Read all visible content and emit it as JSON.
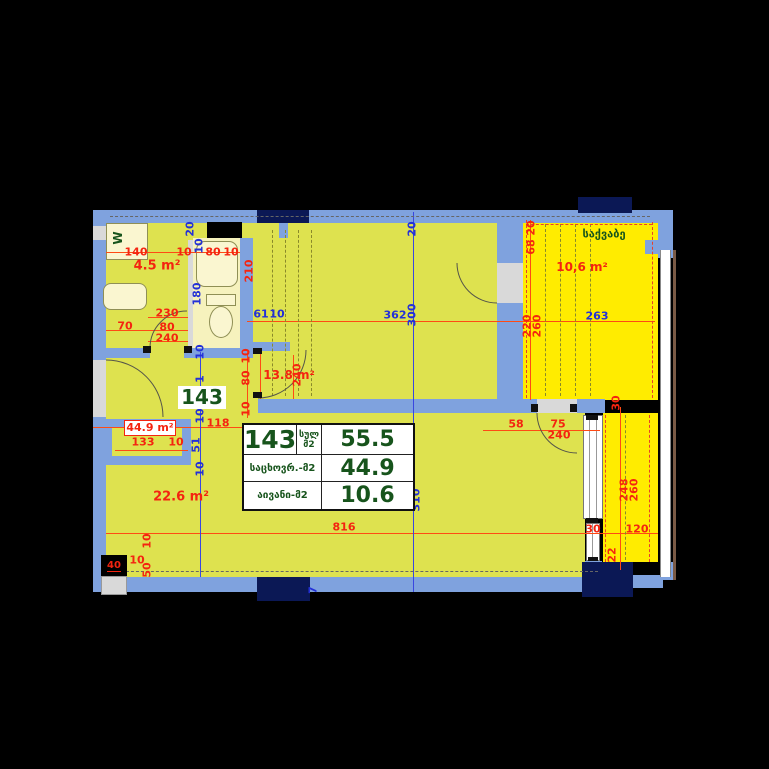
{
  "plan": {
    "apartment_number": "143",
    "rooms": {
      "bathroom": {
        "area": "4.5 m²"
      },
      "bedroom": {
        "area": "13.8 m²"
      },
      "living": {
        "area": "22.6 m²"
      },
      "hall": {
        "area": "44.9 m²"
      },
      "boiler": {
        "name": "საქვაბე",
        "area": "10,6 m²"
      }
    },
    "washer_label": "W",
    "shaft_label": "40"
  },
  "summary_table": {
    "unit": "143",
    "total_unit_label": [
      "სულ",
      "მ2"
    ],
    "total_value": "55.5",
    "rows": [
      {
        "label": "საცხოვრ.-მ2",
        "value": "44.9"
      },
      {
        "label": "აივანი-მ2",
        "value": "10.6"
      }
    ]
  },
  "colors": {
    "wall": "#7FA2DE",
    "column": "#0B1855",
    "interior": "#DEE24F",
    "balcony": "#FFEC00",
    "pale_room": "#F6F2BD",
    "dim_red": "#F42410",
    "dim_blue": "#2330D8",
    "label_green": "#17541C",
    "background": "#000000"
  },
  "dims": [
    {
      "t": "140",
      "x": 136,
      "y": 252,
      "o": "h",
      "c": "r"
    },
    {
      "t": "10",
      "x": 184,
      "y": 252,
      "o": "h",
      "c": "r"
    },
    {
      "t": "80",
      "x": 213,
      "y": 252,
      "o": "h",
      "c": "r"
    },
    {
      "t": "10",
      "x": 231,
      "y": 252,
      "o": "h",
      "c": "r"
    },
    {
      "t": "230",
      "x": 167,
      "y": 313,
      "o": "h",
      "c": "r"
    },
    {
      "t": "70",
      "x": 125,
      "y": 326,
      "o": "h",
      "c": "r"
    },
    {
      "t": "80",
      "x": 167,
      "y": 327,
      "o": "h",
      "c": "r"
    },
    {
      "t": "240",
      "x": 167,
      "y": 338,
      "o": "h",
      "c": "r"
    },
    {
      "t": "118",
      "x": 218,
      "y": 423,
      "o": "h",
      "c": "r"
    },
    {
      "t": "133",
      "x": 143,
      "y": 442,
      "o": "h",
      "c": "r"
    },
    {
      "t": "10",
      "x": 176,
      "y": 442,
      "o": "h",
      "c": "r"
    },
    {
      "t": "58",
      "x": 516,
      "y": 424,
      "o": "h",
      "c": "r"
    },
    {
      "t": "75",
      "x": 558,
      "y": 424,
      "o": "h",
      "c": "r"
    },
    {
      "t": "240",
      "x": 559,
      "y": 435,
      "o": "h",
      "c": "r"
    },
    {
      "t": "816",
      "x": 344,
      "y": 527,
      "o": "h",
      "c": "r"
    },
    {
      "t": "30",
      "x": 593,
      "y": 529,
      "o": "h",
      "c": "r"
    },
    {
      "t": "120",
      "x": 637,
      "y": 529,
      "o": "h",
      "c": "r"
    },
    {
      "t": "10",
      "x": 137,
      "y": 560,
      "o": "h",
      "c": "r"
    },
    {
      "t": "210",
      "x": 249,
      "y": 271,
      "o": "v",
      "c": "r"
    },
    {
      "t": "10",
      "x": 246,
      "y": 356,
      "o": "v",
      "c": "r"
    },
    {
      "t": "80",
      "x": 246,
      "y": 378,
      "o": "v",
      "c": "r"
    },
    {
      "t": "10",
      "x": 246,
      "y": 409,
      "o": "v",
      "c": "r"
    },
    {
      "t": "240",
      "x": 297,
      "y": 375,
      "o": "v",
      "c": "r"
    },
    {
      "t": "20",
      "x": 531,
      "y": 228,
      "o": "v",
      "c": "r"
    },
    {
      "t": "68",
      "x": 531,
      "y": 247,
      "o": "v",
      "c": "r"
    },
    {
      "t": "220",
      "x": 527,
      "y": 326,
      "o": "v",
      "c": "r"
    },
    {
      "t": "260",
      "x": 537,
      "y": 326,
      "o": "v",
      "c": "r"
    },
    {
      "t": "30",
      "x": 616,
      "y": 403,
      "o": "v",
      "c": "r"
    },
    {
      "t": "248",
      "x": 624,
      "y": 490,
      "o": "v",
      "c": "r"
    },
    {
      "t": "260",
      "x": 634,
      "y": 490,
      "o": "v",
      "c": "r"
    },
    {
      "t": "22",
      "x": 612,
      "y": 555,
      "o": "v",
      "c": "r"
    },
    {
      "t": "10",
      "x": 147,
      "y": 541,
      "o": "v",
      "c": "r"
    },
    {
      "t": "50",
      "x": 147,
      "y": 570,
      "o": "v",
      "c": "r"
    },
    {
      "t": "61",
      "x": 261,
      "y": 314,
      "o": "h",
      "c": "b"
    },
    {
      "t": "10",
      "x": 277,
      "y": 314,
      "o": "h",
      "c": "b"
    },
    {
      "t": "362",
      "x": 395,
      "y": 315,
      "o": "h",
      "c": "b"
    },
    {
      "t": "263",
      "x": 597,
      "y": 316,
      "o": "h",
      "c": "b"
    },
    {
      "t": "20",
      "x": 190,
      "y": 229,
      "o": "v",
      "c": "b"
    },
    {
      "t": "10",
      "x": 199,
      "y": 246,
      "o": "v",
      "c": "b"
    },
    {
      "t": "180",
      "x": 197,
      "y": 294,
      "o": "v",
      "c": "b"
    },
    {
      "t": "10",
      "x": 200,
      "y": 352,
      "o": "v",
      "c": "b"
    },
    {
      "t": "20",
      "x": 412,
      "y": 229,
      "o": "v",
      "c": "b"
    },
    {
      "t": "300",
      "x": 412,
      "y": 315,
      "o": "v",
      "c": "b"
    },
    {
      "t": "310",
      "x": 416,
      "y": 500,
      "o": "v",
      "c": "b"
    },
    {
      "t": "1",
      "x": 200,
      "y": 379,
      "o": "v",
      "c": "b"
    },
    {
      "t": "10",
      "x": 200,
      "y": 416,
      "o": "v",
      "c": "b"
    },
    {
      "t": "51",
      "x": 196,
      "y": 445,
      "o": "v",
      "c": "b"
    },
    {
      "t": "10",
      "x": 200,
      "y": 469,
      "o": "v",
      "c": "b"
    },
    {
      "t": "7",
      "x": 313,
      "y": 590,
      "o": "v",
      "c": "b"
    }
  ]
}
